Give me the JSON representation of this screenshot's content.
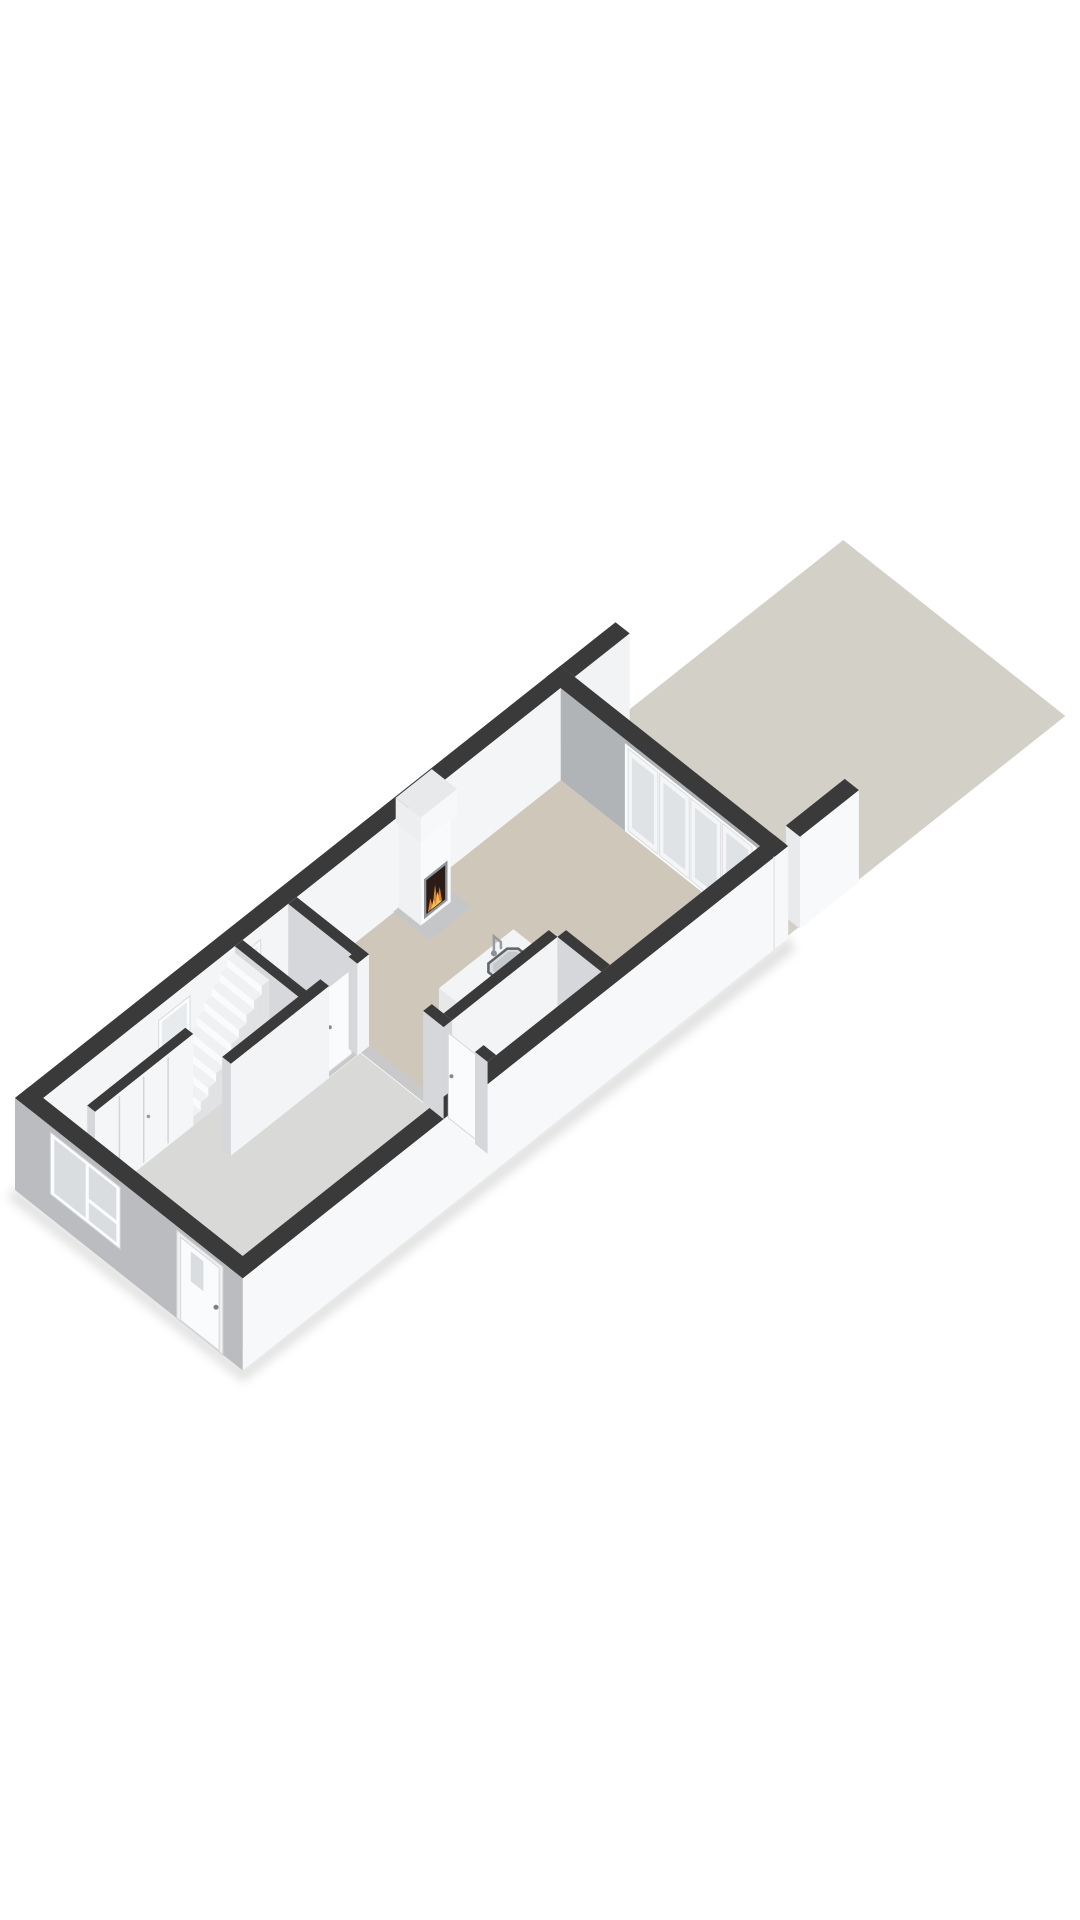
{
  "meta": {
    "kind": "3d-floorplan-render",
    "background": "#ffffff"
  },
  "palette": {
    "background": "#ffffff",
    "garden": "#d2d0c7",
    "wall_top": "#3a3a3b",
    "front_facade": "#babcbf",
    "side_facade": "#f7f8f9",
    "inner_wall_bright": "#f4f5f6",
    "inner_wall_shaded": "#d5d7da",
    "back_wall_inner": "#b1b4b7",
    "living_floor": "#cfc7ba",
    "hall_floor": "#d9d9d8",
    "small_room_floor": "#ebebec",
    "hearth": "#c5c6c8",
    "window_pane": "#d9dde0",
    "fire_orange": "#dd7f2c",
    "fire_yellow": "#f6bf4a",
    "firebox_dark": "#2a1d15"
  },
  "projection": {
    "origin": [
      15,
      1190
    ],
    "ux": 0.785,
    "uy": -0.622,
    "vx": 0.785,
    "vy": 0.622
  },
  "scene": [
    {
      "name": "ground-shadow",
      "type": "screenPoly",
      "pts": [
        [
          8,
          1198
        ],
        [
          243,
          1382
        ],
        [
          795,
          950
        ],
        [
          789,
          936
        ],
        [
          243,
          1367
        ],
        [
          14,
          1187
        ]
      ],
      "fill": "#9a9a98",
      "opacity": 0.3,
      "blur": true
    },
    {
      "name": "garden-terrace",
      "type": "floor",
      "u": [
        695,
        1050
      ],
      "v": [
        5,
        288
      ],
      "z": 0,
      "fill": "#d2d0c7"
    },
    {
      "name": "party-wall-stub-left",
      "type": "box",
      "u": [
        695,
        765
      ],
      "v": [
        0,
        18
      ],
      "z": [
        0,
        92
      ],
      "top": "#3a3a3b",
      "se": "#f2f3f4"
    },
    {
      "name": "back-wall-top",
      "type": "floor",
      "u": [
        677,
        695
      ],
      "v": [
        0,
        290
      ],
      "z": 92,
      "fill": "#3a3a3b"
    },
    {
      "name": "back-wall-inner-face",
      "type": "panel",
      "plane": "u",
      "at": 677,
      "a": [
        18,
        290
      ],
      "z": [
        0,
        92
      ],
      "fill": "#b1b4b7"
    },
    {
      "name": "patio-doorset-frame",
      "type": "panel",
      "plane": "u",
      "at": 677,
      "a": [
        100,
        268
      ],
      "z": [
        0,
        88
      ],
      "fill": "#fbfcfd"
    },
    {
      "name": "patio-door-1",
      "type": "panel",
      "plane": "u",
      "at": 677,
      "a": [
        104,
        142
      ],
      "z": [
        3,
        85
      ],
      "fill": "#f4f5f6",
      "stroke": "#dddee0",
      "w": 1
    },
    {
      "name": "patio-door-1-pane",
      "type": "panel",
      "plane": "u",
      "at": 677,
      "a": [
        109,
        137
      ],
      "z": [
        9,
        79
      ],
      "fill": "#dfe3e6"
    },
    {
      "name": "patio-door-2",
      "type": "panel",
      "plane": "u",
      "at": 677,
      "a": [
        144,
        182
      ],
      "z": [
        3,
        85
      ],
      "fill": "#f4f5f6",
      "stroke": "#dddee0",
      "w": 1
    },
    {
      "name": "patio-door-2-pane",
      "type": "panel",
      "plane": "u",
      "at": 677,
      "a": [
        149,
        177
      ],
      "z": [
        9,
        79
      ],
      "fill": "#dfe3e6"
    },
    {
      "name": "patio-door-3",
      "type": "panel",
      "plane": "u",
      "at": 677,
      "a": [
        184,
        222
      ],
      "z": [
        3,
        85
      ],
      "fill": "#f4f5f6",
      "stroke": "#dddee0",
      "w": 1
    },
    {
      "name": "patio-door-3-pane",
      "type": "panel",
      "plane": "u",
      "at": 677,
      "a": [
        189,
        217
      ],
      "z": [
        9,
        79
      ],
      "fill": "#dfe3e6"
    },
    {
      "name": "patio-door-4",
      "type": "panel",
      "plane": "u",
      "at": 677,
      "a": [
        224,
        262
      ],
      "z": [
        3,
        85
      ],
      "fill": "#f4f5f6",
      "stroke": "#dddee0",
      "w": 1
    },
    {
      "name": "patio-door-4-pane",
      "type": "panel",
      "plane": "u",
      "at": 677,
      "a": [
        229,
        257
      ],
      "z": [
        9,
        79
      ],
      "fill": "#dfe3e6"
    },
    {
      "name": "party-wall-stub-right",
      "type": "box",
      "u": [
        710,
        785
      ],
      "v": [
        272,
        290
      ],
      "z": [
        0,
        92
      ],
      "top": "#3a3a3b",
      "se": "#f8f9fa",
      "sw": "#e9eaec"
    },
    {
      "name": "living-room-floor",
      "type": "floor",
      "u": [
        341,
        677
      ],
      "v": [
        18,
        272
      ],
      "z": 0,
      "fill": "#cfc7ba"
    },
    {
      "name": "hall-floor",
      "type": "floor",
      "u": [
        18,
        330
      ],
      "v": [
        18,
        272
      ],
      "z": 0,
      "fill": "#d9d9d8"
    },
    {
      "name": "wc-floor",
      "type": "floor",
      "u": [
        272,
        330
      ],
      "v": [
        18,
        110
      ],
      "z": 0,
      "fill": "#ebebec"
    },
    {
      "name": "storeroom-floor",
      "type": "floor",
      "u": [
        341,
        475
      ],
      "v": [
        216,
        272
      ],
      "z": 0,
      "fill": "#ededee"
    },
    {
      "name": "passage-threshold",
      "type": "floor",
      "u": [
        330,
        341
      ],
      "v": [
        110,
        190
      ],
      "z": 1,
      "fill": "#c9c9cb"
    },
    {
      "name": "storeroom-door-threshold",
      "type": "floor",
      "u": [
        330,
        341
      ],
      "v": [
        216,
        256
      ],
      "z": 1,
      "fill": "#c9c9cb"
    },
    {
      "name": "wc-door-threshold",
      "type": "floor",
      "u": [
        290,
        326
      ],
      "v": [
        99,
        110
      ],
      "z": 1,
      "fill": "#c9c9cb"
    },
    {
      "name": "front-door-threshold",
      "type": "floor",
      "u": [
        0,
        18
      ],
      "v": [
        206,
        265
      ],
      "z": 1,
      "fill": "#c9c9cb"
    },
    {
      "name": "left-wall-top",
      "type": "floor",
      "u": [
        0,
        695
      ],
      "v": [
        0,
        18
      ],
      "z": 92,
      "fill": "#3a3a3b"
    },
    {
      "name": "left-wall-inner-face",
      "type": "panel",
      "plane": "v",
      "at": 18,
      "a": [
        0,
        677
      ],
      "z": [
        0,
        92
      ],
      "fill": "#f4f5f6"
    },
    {
      "name": "left-window-1-frame",
      "type": "panel",
      "plane": "v",
      "at": 18,
      "a": [
        165,
        205
      ],
      "z": [
        42,
        78
      ],
      "fill": "#fbfcfd",
      "stroke": "#d9dadb",
      "w": 1
    },
    {
      "name": "left-window-1-pane",
      "type": "panel",
      "plane": "v",
      "at": 18,
      "a": [
        169,
        201
      ],
      "z": [
        46,
        74
      ],
      "fill": "#e8ebee"
    },
    {
      "name": "left-window-2-frame",
      "type": "panel",
      "plane": "v",
      "at": 18,
      "a": [
        255,
        295
      ],
      "z": [
        42,
        78
      ],
      "fill": "#fbfcfd",
      "stroke": "#d9dadb",
      "w": 1
    },
    {
      "name": "left-window-2-pane",
      "type": "panel",
      "plane": "v",
      "at": 18,
      "a": [
        259,
        291
      ],
      "z": [
        46,
        74
      ],
      "fill": "#e8ebee"
    },
    {
      "name": "fireplace-hearth",
      "type": "floor",
      "u": [
        464,
        518
      ],
      "v": [
        18,
        64
      ],
      "z": 1,
      "fill": "#c5c6c8"
    },
    {
      "name": "fireplace-chimney",
      "type": "box",
      "u": [
        471,
        509
      ],
      "v": [
        18,
        46
      ],
      "z": [
        0,
        88
      ],
      "sw": "#f0f1f3",
      "se": "#f9fafb"
    },
    {
      "name": "fireplace-mantel",
      "type": "box",
      "u": [
        467,
        513
      ],
      "v": [
        18,
        50
      ],
      "z": [
        88,
        113
      ],
      "top": "#e8e9eb",
      "sw": "#edeef0",
      "se": "#f7f8fa"
    },
    {
      "name": "firebox-frame",
      "type": "panel",
      "plane": "v",
      "at": 46,
      "a": [
        475,
        505
      ],
      "z": [
        4,
        44
      ],
      "fill": "#90949a"
    },
    {
      "name": "firebox-opening",
      "type": "panel",
      "plane": "v",
      "at": 46,
      "a": [
        478,
        502
      ],
      "z": [
        7,
        41
      ],
      "fill": "#2a1d15"
    },
    {
      "name": "fire-flame-outer",
      "type": "panelPoly",
      "plane": "v",
      "at": 46,
      "pts": [
        [
          480,
          8
        ],
        [
          483,
          20
        ],
        [
          486,
          10
        ],
        [
          489,
          30
        ],
        [
          492,
          12
        ],
        [
          495,
          24
        ],
        [
          498,
          8
        ]
      ],
      "fill": "#dd7f2c"
    },
    {
      "name": "fire-flame-inner",
      "type": "panelPoly",
      "plane": "v",
      "at": 46,
      "pts": [
        [
          484,
          8
        ],
        [
          487,
          16
        ],
        [
          490,
          9
        ],
        [
          492,
          21
        ],
        [
          495,
          10
        ],
        [
          497,
          8
        ]
      ],
      "fill": "#f6bf4a"
    },
    {
      "name": "kitchen-island",
      "type": "box",
      "u": [
        400,
        495
      ],
      "v": [
        140,
        205
      ],
      "z": [
        0,
        40
      ],
      "top": "#f3f4f5",
      "sw": "#e7e8ea",
      "se": "#fbfcfd"
    },
    {
      "name": "sink-rim",
      "type": "planPoly",
      "z": 40.5,
      "pts": [
        [
          451,
          152
        ],
        [
          475,
          152
        ],
        [
          482,
          159
        ],
        [
          482,
          187
        ],
        [
          475,
          194
        ],
        [
          451,
          194
        ],
        [
          444,
          187
        ],
        [
          444,
          159
        ]
      ],
      "fill": "#d9dcdf",
      "stroke": "#5f646a",
      "w": 2.5
    },
    {
      "name": "sink-basin",
      "type": "planPoly",
      "z": 41,
      "pts": [
        [
          453,
          156
        ],
        [
          473,
          156
        ],
        [
          478,
          161
        ],
        [
          478,
          185
        ],
        [
          473,
          190
        ],
        [
          453,
          190
        ],
        [
          448,
          185
        ],
        [
          448,
          161
        ]
      ],
      "fill": "#c5c9cc"
    },
    {
      "name": "sink-faucet",
      "type": "line3d",
      "pts": [
        [
          463,
          147,
          40
        ],
        [
          463,
          147,
          57
        ],
        [
          463,
          156,
          57
        ],
        [
          463,
          156,
          51
        ]
      ],
      "stroke": "#989ca0",
      "w": 2.5
    },
    {
      "name": "sink-faucet-base",
      "type": "dot3d",
      "p": [
        463,
        147,
        40
      ],
      "r": 3,
      "fill": "#8b8f93"
    },
    {
      "name": "storeroom-wall-v",
      "type": "box",
      "u": [
        475,
        486
      ],
      "v": [
        216,
        272
      ],
      "z": [
        0,
        92
      ],
      "top": "#3a3a3b",
      "sw": "#d5d7da"
    },
    {
      "name": "storeroom-wall-u",
      "type": "box",
      "u": [
        341,
        475
      ],
      "v": [
        205,
        216
      ],
      "z": [
        0,
        92
      ],
      "top": "#3a3a3b",
      "se": "#f3f4f6",
      "sw": "#d5d7da"
    },
    {
      "name": "right-wall-top",
      "type": "floor",
      "u": [
        0,
        695
      ],
      "v": [
        272,
        290
      ],
      "z": 92,
      "fill": "#3a3a3b"
    },
    {
      "name": "right-wall-outer-face",
      "type": "panel",
      "plane": "v",
      "at": 290,
      "a": [
        0,
        695
      ],
      "z": [
        0,
        92
      ],
      "fill": "#f7f8f9"
    },
    {
      "name": "right-wall-seam",
      "type": "line3d",
      "pts": [
        [
          677,
          290,
          0
        ],
        [
          677,
          290,
          92
        ]
      ],
      "stroke": "#e4e5e7",
      "w": 1.5
    },
    {
      "name": "hall-living-wall-a",
      "type": "box",
      "u": [
        330,
        341
      ],
      "v": [
        18,
        110
      ],
      "z": [
        0,
        92
      ],
      "top": "#3a3a3b",
      "sw": "#d5d7da",
      "se": "#f3f4f6"
    },
    {
      "name": "hall-living-wall-b",
      "type": "box",
      "u": [
        330,
        341
      ],
      "v": [
        190,
        216
      ],
      "z": [
        0,
        92
      ],
      "top": "#3a3a3b",
      "sw": "#d5d7da"
    },
    {
      "name": "storeroom-door-leaf",
      "type": "panel",
      "plane": "u",
      "at": 334,
      "a": [
        218,
        254
      ],
      "z": [
        0,
        85
      ],
      "fill": "#fafbfc",
      "stroke": "#d8d9da",
      "w": 1
    },
    {
      "name": "storeroom-door-handle",
      "type": "dot3d",
      "p": [
        334,
        222,
        44
      ],
      "r": 2,
      "fill": "#85898d"
    },
    {
      "name": "hall-living-wall-c",
      "type": "box",
      "u": [
        330,
        341
      ],
      "v": [
        256,
        272
      ],
      "z": [
        0,
        92
      ],
      "top": "#3a3a3b",
      "sw": "#d5d7da"
    },
    {
      "name": "stair-wall",
      "type": "box",
      "u": [
        262,
        272
      ],
      "v": [
        18,
        110
      ],
      "z": [
        0,
        92
      ],
      "top": "#3a3a3b",
      "sw": "#d6d8db"
    },
    {
      "name": "wc-door-leaf",
      "type": "panel",
      "plane": "v",
      "at": 105,
      "a": [
        292,
        324
      ],
      "z": [
        0,
        85
      ],
      "fill": "#fafbfc",
      "stroke": "#d8d9da",
      "w": 1
    },
    {
      "name": "wc-door-handle",
      "type": "dot3d",
      "p": [
        296,
        105,
        44
      ],
      "r": 2,
      "fill": "#85898d"
    },
    {
      "name": "staircase",
      "type": "stairs",
      "u0": 165,
      "n": 10,
      "tread": 9.7,
      "v": [
        18,
        62
      ],
      "rise": 8.5,
      "base": 9,
      "top": "#f0f1f2",
      "riser": "#fafbfc",
      "side": "#e0e2e4"
    },
    {
      "name": "hall-closet",
      "type": "box",
      "u": [
        40,
        165
      ],
      "v": [
        52,
        62
      ],
      "z": [
        0,
        92
      ],
      "top": "#3a3a3b",
      "se": "#f5f6f7",
      "sw": "#d5d7da"
    },
    {
      "name": "closet-seam-1",
      "type": "line3d",
      "pts": [
        [
          71,
          62,
          3
        ],
        [
          71,
          62,
          88
        ]
      ],
      "stroke": "#d4d5d6",
      "w": 1.5
    },
    {
      "name": "closet-seam-2",
      "type": "line3d",
      "pts": [
        [
          102,
          62,
          3
        ],
        [
          102,
          62,
          88
        ]
      ],
      "stroke": "#d4d5d6",
      "w": 1.5
    },
    {
      "name": "closet-seam-3",
      "type": "line3d",
      "pts": [
        [
          133,
          62,
          3
        ],
        [
          133,
          62,
          88
        ]
      ],
      "stroke": "#d4d5d6",
      "w": 1.5
    },
    {
      "name": "closet-handle",
      "type": "dot3d",
      "p": [
        108,
        62,
        45
      ],
      "r": 1.8,
      "fill": "#9a9ea2"
    },
    {
      "name": "corridor-wall-a",
      "type": "box",
      "u": [
        165,
        290
      ],
      "v": [
        99,
        110
      ],
      "z": [
        0,
        92
      ],
      "top": "#3a3a3b",
      "sw": "#d5d7da",
      "se": "#f3f4f6"
    },
    {
      "name": "corridor-wall-b",
      "type": "box",
      "u": [
        326,
        341
      ],
      "v": [
        99,
        110
      ],
      "z": [
        0,
        92
      ],
      "top": "#3a3a3b",
      "sw": "#d5d7da",
      "se": "#f3f4f6"
    },
    {
      "name": "front-wall-top",
      "type": "floor",
      "u": [
        0,
        18
      ],
      "v": [
        0,
        290
      ],
      "z": 92,
      "fill": "#3a3a3b"
    },
    {
      "name": "front-facade",
      "type": "panel",
      "plane": "u",
      "at": 0,
      "a": [
        0,
        290
      ],
      "z": [
        0,
        92
      ],
      "fill": "#babcbf"
    },
    {
      "name": "front-window-frame",
      "type": "panel",
      "plane": "u",
      "at": 0,
      "a": [
        45,
        134
      ],
      "z": [
        24,
        86
      ],
      "fill": "#fbfcfd",
      "stroke": "#d0d1d3",
      "w": 1
    },
    {
      "name": "front-window-pane-left",
      "type": "panel",
      "plane": "u",
      "at": 0,
      "a": [
        50,
        90
      ],
      "z": [
        28,
        82
      ],
      "fill": "#d9dde0"
    },
    {
      "name": "front-window-pane-right-upper",
      "type": "panel",
      "plane": "u",
      "at": 0,
      "a": [
        94,
        129
      ],
      "z": [
        50,
        82
      ],
      "fill": "#d9dde0"
    },
    {
      "name": "front-window-pane-right-lower",
      "type": "panel",
      "plane": "u",
      "at": 0,
      "a": [
        94,
        129
      ],
      "z": [
        28,
        46
      ],
      "fill": "#d9dde0"
    },
    {
      "name": "front-door-frame",
      "type": "panel",
      "plane": "u",
      "at": 0,
      "a": [
        206,
        265
      ],
      "z": [
        0,
        88
      ],
      "fill": "#eff0f1",
      "stroke": "#d0d1d3",
      "w": 1
    },
    {
      "name": "front-door-leaf",
      "type": "panel",
      "plane": "u",
      "at": 0,
      "a": [
        211,
        260
      ],
      "z": [
        1,
        84
      ],
      "fill": "#fafbfc",
      "stroke": "#d6d7d8",
      "w": 1
    },
    {
      "name": "front-door-pane",
      "type": "panel",
      "plane": "u",
      "at": 0,
      "a": [
        224,
        240
      ],
      "z": [
        48,
        78
      ],
      "fill": "#d9dde0"
    },
    {
      "name": "front-door-handle",
      "type": "dot3d",
      "p": [
        0,
        256,
        42
      ],
      "r": 2.5,
      "fill": "#7d8185"
    }
  ]
}
